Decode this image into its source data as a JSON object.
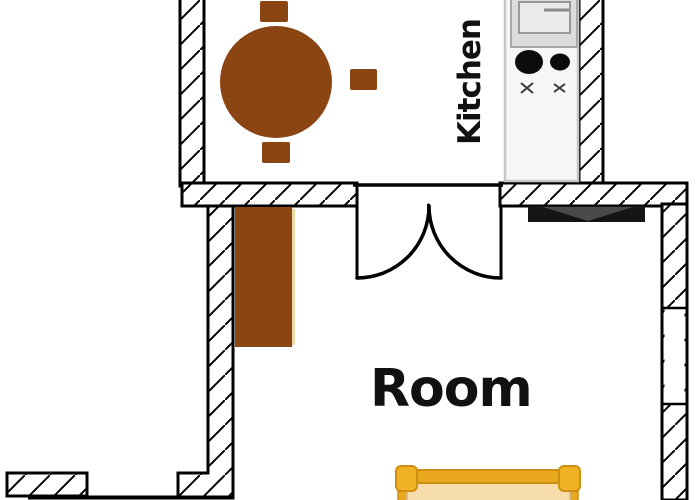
{
  "page": {
    "type": "apartment-floor-plan",
    "rooms": [
      "Kitchen",
      "Room"
    ]
  },
  "labels": {
    "kitchen": "Kitchen",
    "room": "Room"
  },
  "colors": {
    "background": "#ffffff",
    "wall_line": "#000000",
    "furniture_brown": "#8B4513",
    "wardrobe_highlight": "#EDD9A2",
    "counter_fill": "#F6F6F6",
    "counter_border": "#C6C6C6",
    "sink_fill": "#DCDCDC",
    "sink_basin_fill": "#EBEBEB",
    "burner_black": "#0B0B0B",
    "radiator_dark": "#151515",
    "radiator_shade": "#4A4A4A",
    "bed_frame_gold": "#E9A71E",
    "bed_post_gold": "#F0B124",
    "bed_outline_gold": "#CF8F10",
    "mattress_tan": "#F7DCAC",
    "mattress_border": "#E2B97A"
  },
  "fixtures": {
    "dining_table": "dining-table",
    "chairs": [
      "chair-top",
      "chair-right",
      "chair-bottom"
    ],
    "wardrobe": "wardrobe",
    "kitchen_counter": "kitchen-counter",
    "sink": "sink-unit",
    "stove": "stove-burners",
    "radiator": "radiator",
    "double_door": "double-door-swing",
    "window": "window-opening",
    "bed": "bed"
  }
}
